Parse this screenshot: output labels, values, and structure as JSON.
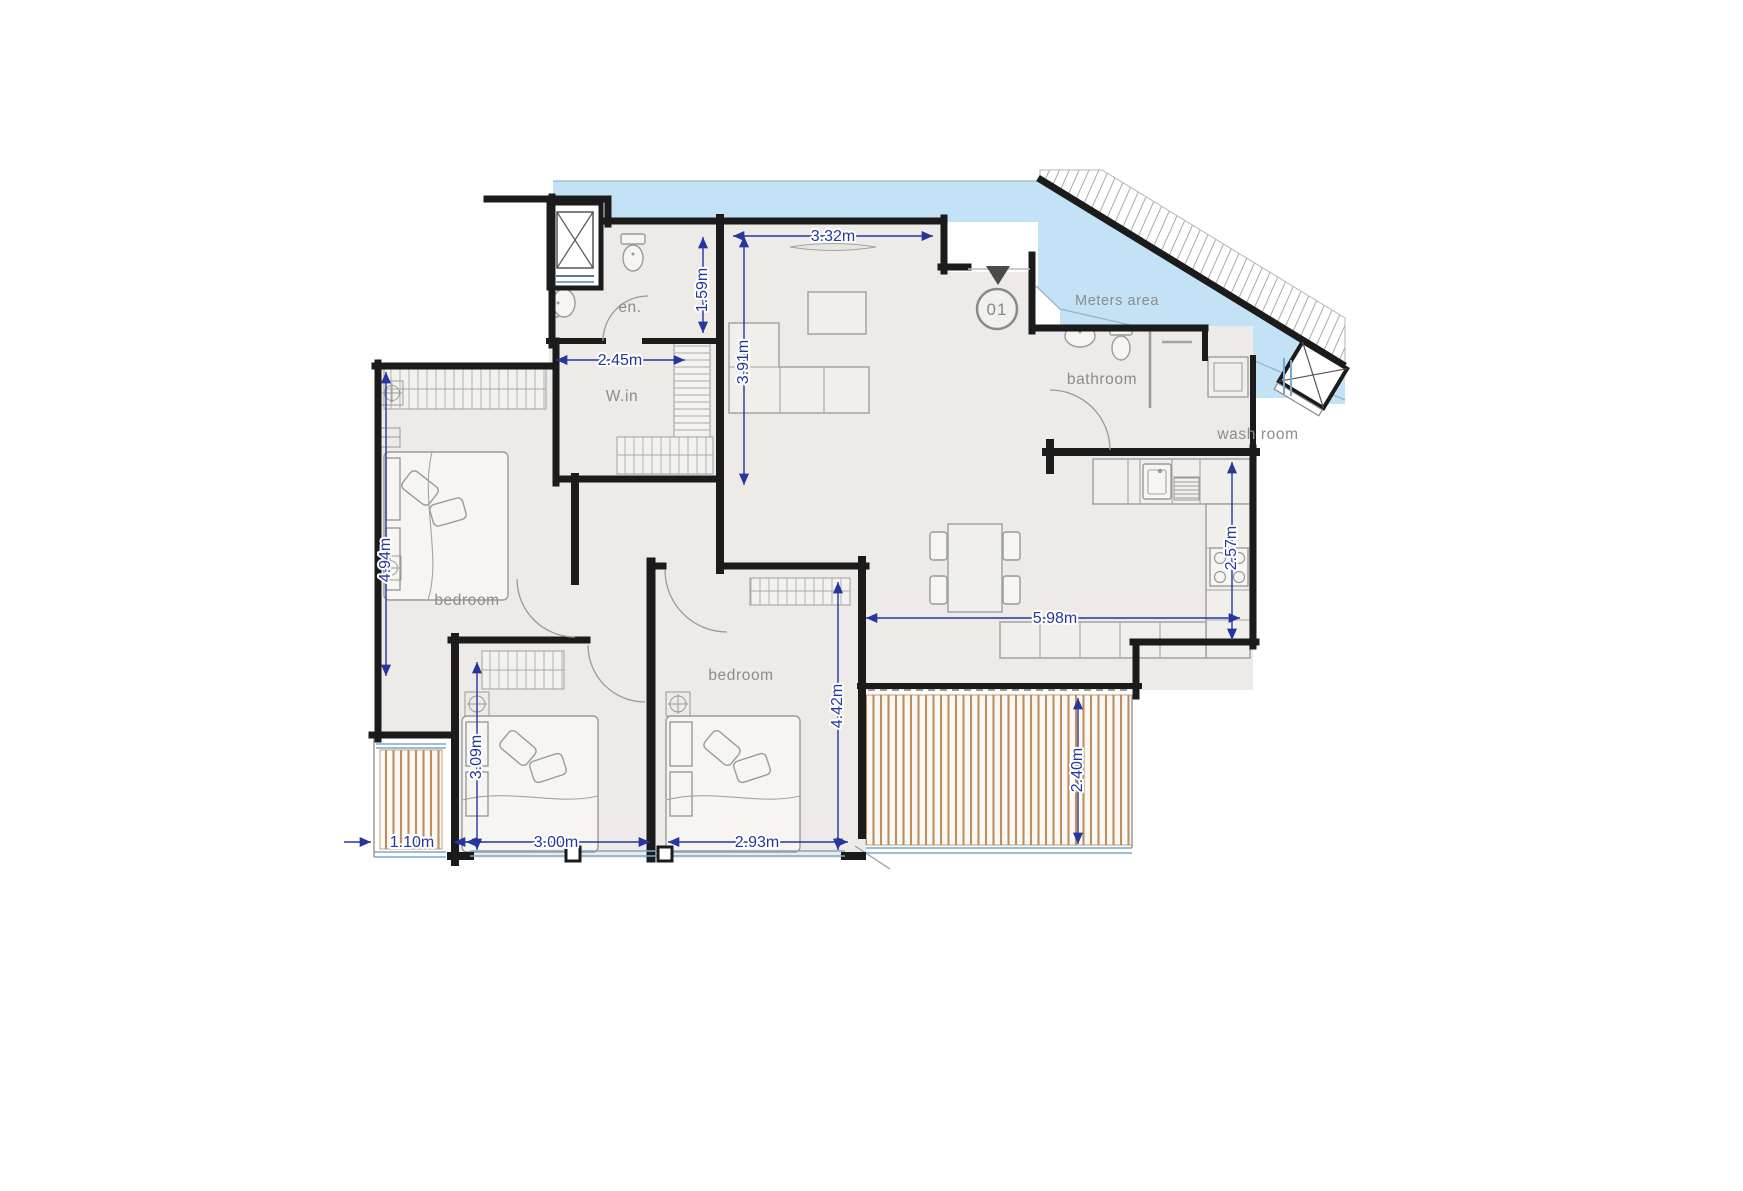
{
  "labels": {
    "ensuite": "en.",
    "walk_in": "W.in",
    "bedroom_left": "bedroom",
    "bedroom_right": "bedroom",
    "bathroom": "bathroom",
    "wash_room": "wash room",
    "meters_area": "Meters area",
    "unit_number": "01"
  },
  "dimensions": {
    "living_width": "3.32m",
    "ensuite_height": "1.59m",
    "walkin_width": "2.45m",
    "living_height": "3.91m",
    "bedroom1_height": "4.94m",
    "bedroom2_height": "3.09m",
    "balcony1_width": "1.10m",
    "bedroom2_width": "3.00m",
    "bedroom3_width": "2.93m",
    "bedroom3_height": "4.42m",
    "living_dining_width": "5.98m",
    "kitchen_height": "2.57m",
    "balcony2_height": "2.40m"
  },
  "colors": {
    "water": "#c3e2f5",
    "wall": "#1b1b1b",
    "floor": "#edeae7",
    "dimension": "#25379c",
    "room_label": "#8c8c8c",
    "deck_stripe": "#c09058",
    "window": "#7ba7cc"
  }
}
